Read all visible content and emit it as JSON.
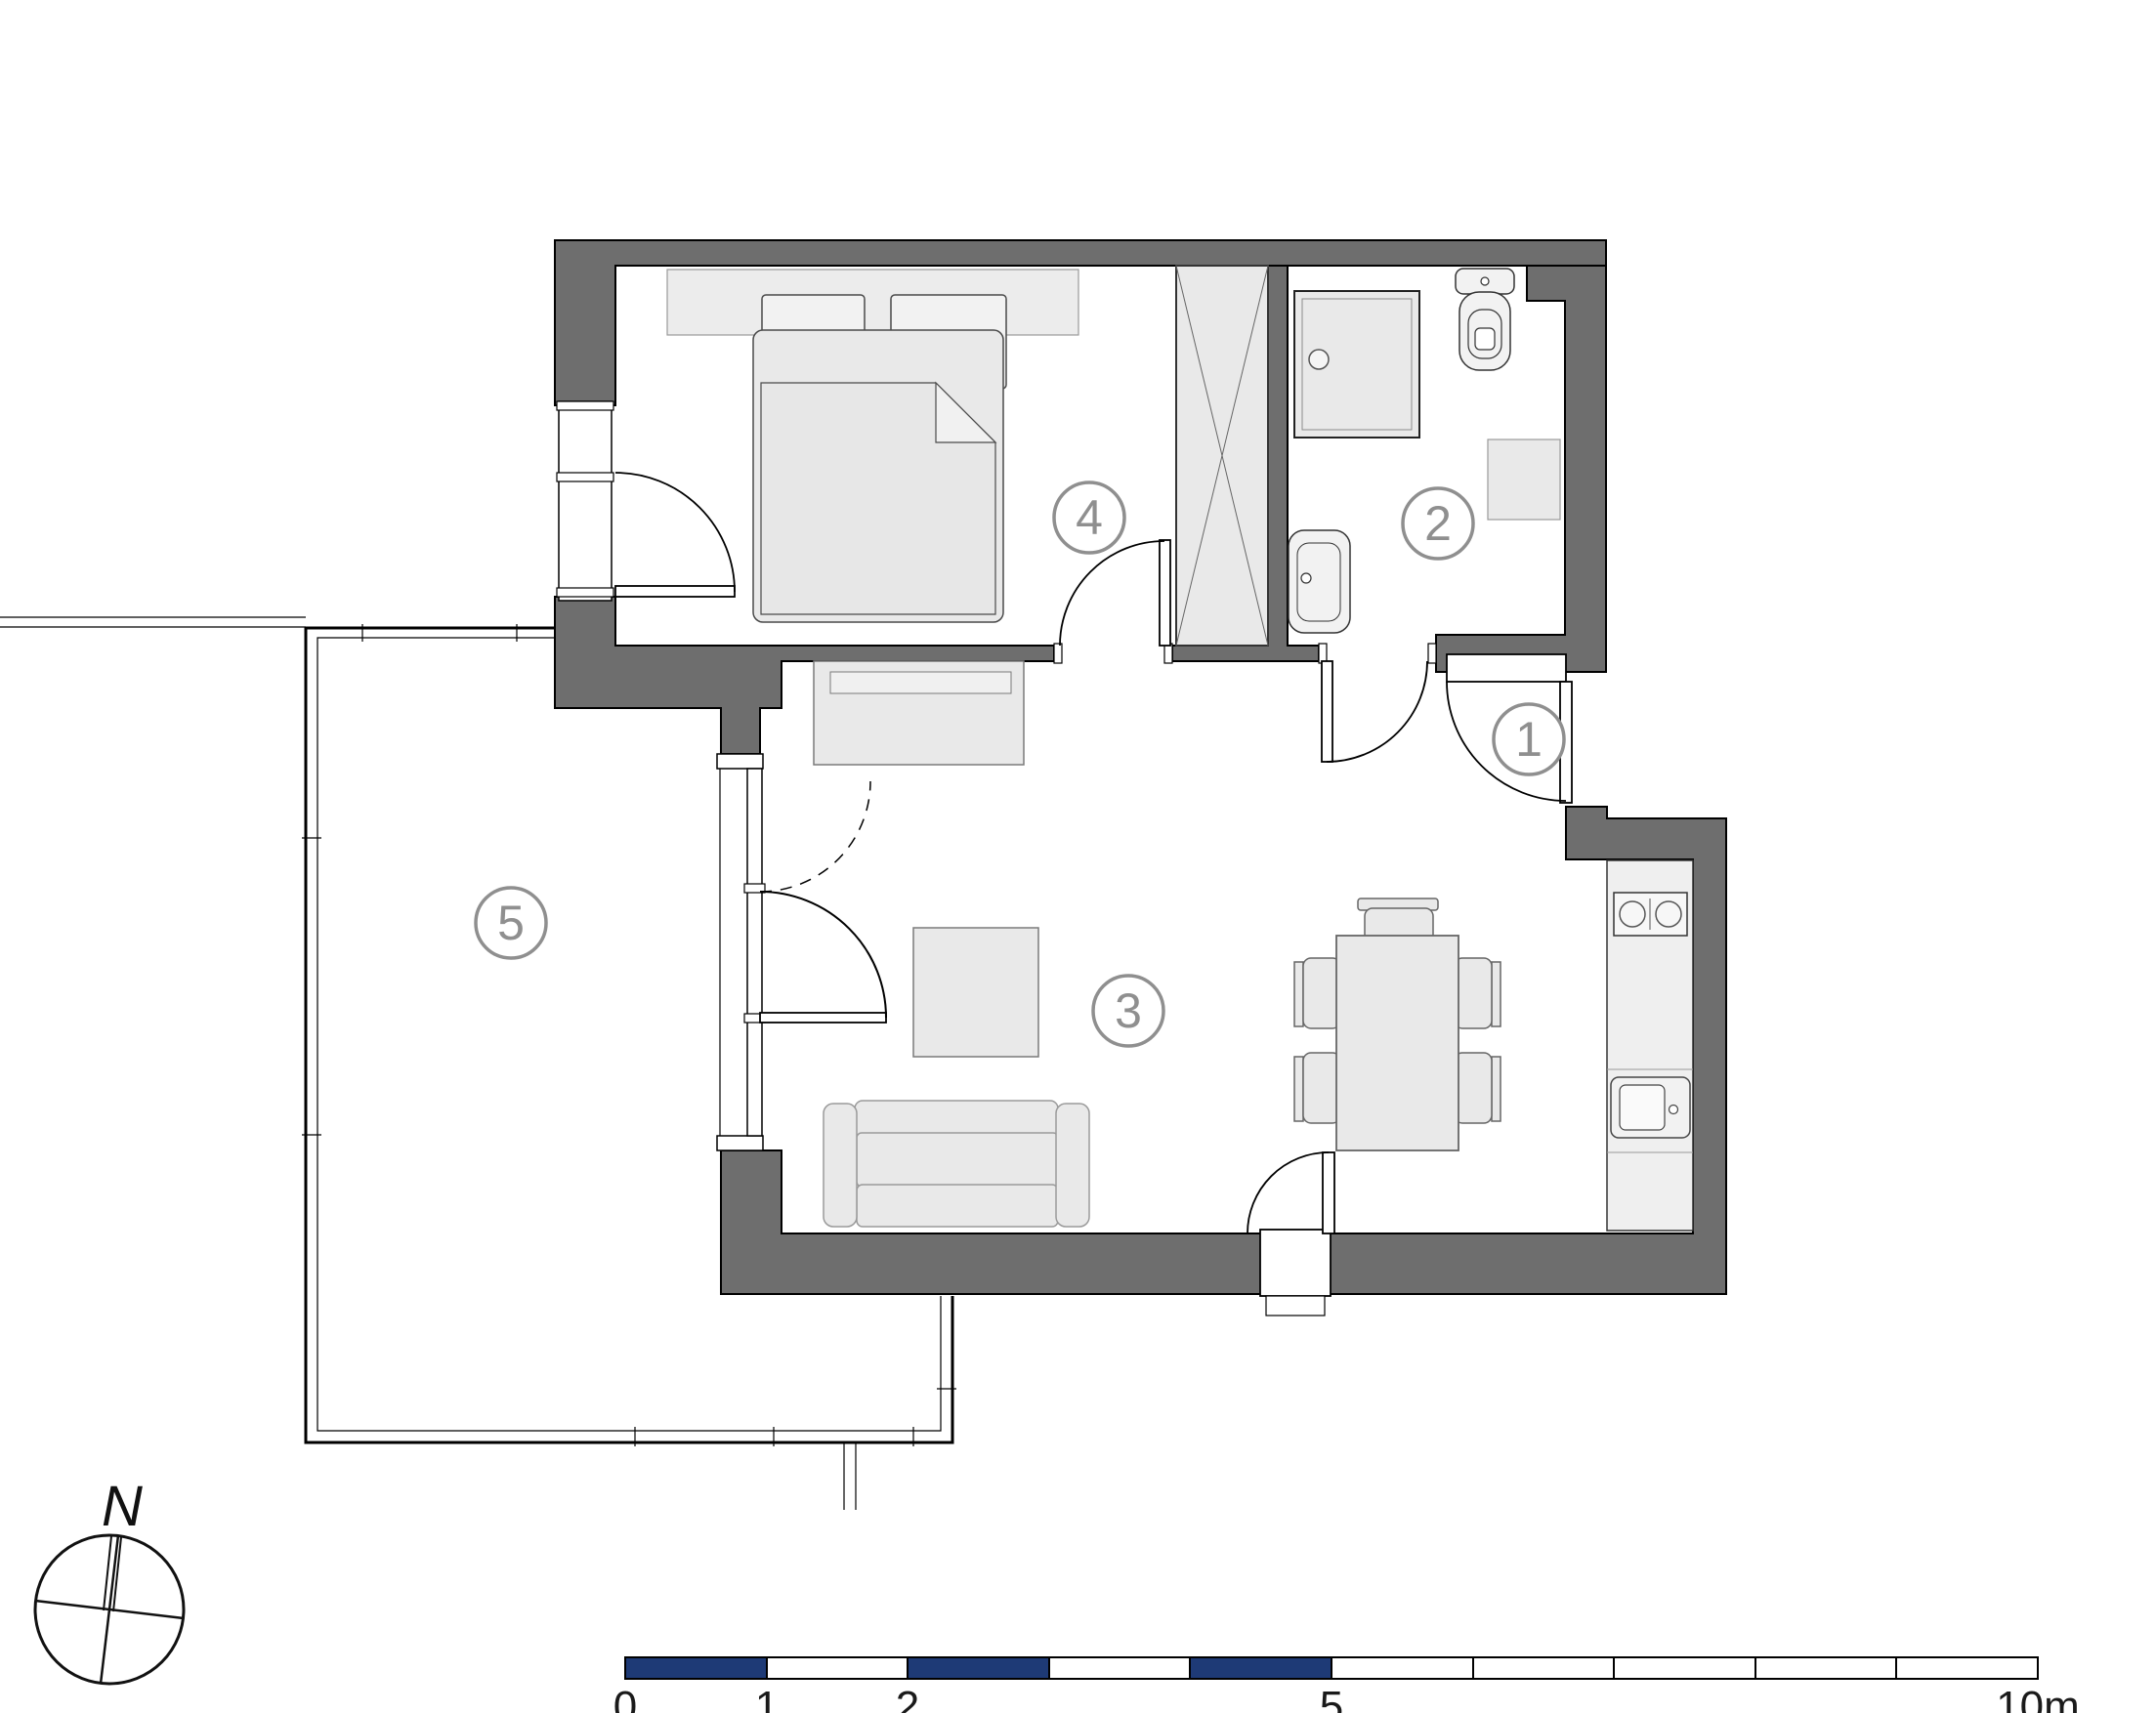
{
  "plan": {
    "rooms": [
      {
        "number": "1",
        "name": "entrance-hall"
      },
      {
        "number": "2",
        "name": "bathroom"
      },
      {
        "number": "3",
        "name": "living-room-kitchen"
      },
      {
        "number": "4",
        "name": "bedroom"
      },
      {
        "number": "5",
        "name": "balcony"
      }
    ],
    "compass": {
      "north_label": "N"
    },
    "scale_bar": {
      "labels": [
        "0",
        "1",
        "2",
        "5",
        "10m"
      ],
      "bar_fill_color": "#1e3a76",
      "bar_outline_color": "#000000"
    },
    "colors": {
      "wall": "#6e6e6e",
      "furniture": "#e9e9e9",
      "outline": "#000000",
      "room_label": "#8f8f8f"
    }
  }
}
